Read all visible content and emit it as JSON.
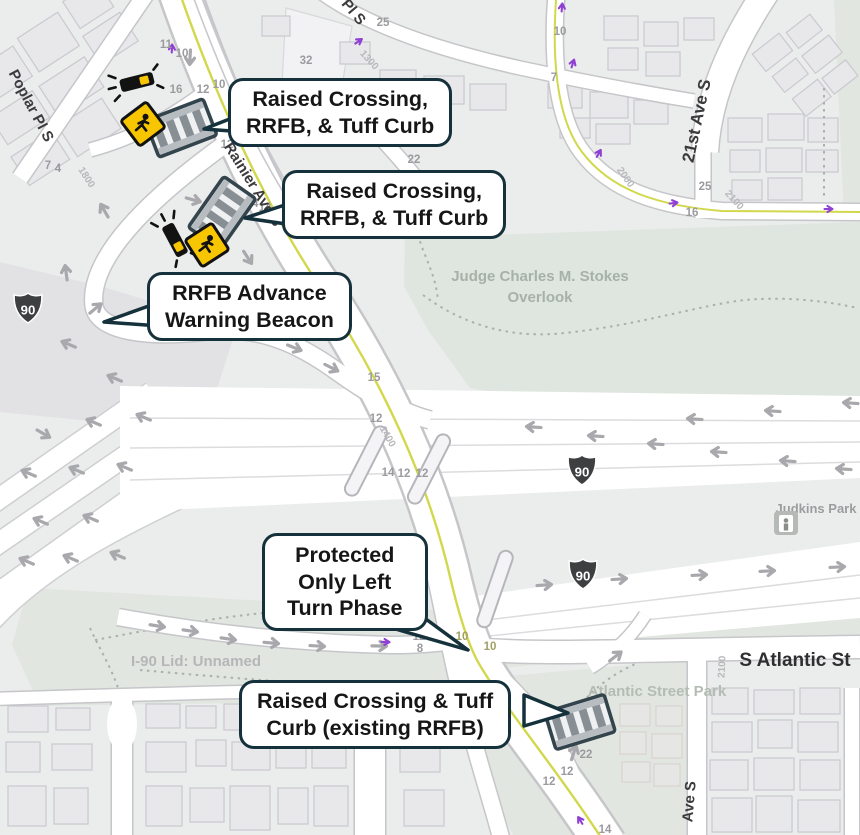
{
  "map": {
    "callouts": [
      {
        "text": "Raised Crossing,\nRRFB, & Tuff Curb"
      },
      {
        "text": "Raised Crossing,\nRRFB, & Tuff Curb"
      },
      {
        "text": "RRFB Advance\nWarning Beacon"
      },
      {
        "text": "Protected\nOnly Left\nTurn Phase"
      },
      {
        "text": "Raised Crossing & Tuff\nCurb (existing RRFB)"
      }
    ],
    "street_labels": [
      "Poplar Pl S",
      "Rainier Ave S",
      "Pl S",
      "21st Ave S",
      "S Atlantic St",
      "Ave S"
    ],
    "place_labels": [
      "Judge Charles M. Stokes",
      "Overlook",
      "Judkins Park",
      "I-90 Lid: Unnamed",
      "Atlantic Street Park"
    ],
    "route_shields": [
      "90",
      "90",
      "90"
    ],
    "road_numbers": [
      "11",
      "10",
      "16",
      "12",
      "10",
      "12",
      "7",
      "4",
      "14",
      "14",
      "22",
      "25",
      "32",
      "15",
      "12",
      "14",
      "12",
      "12",
      "12",
      "8",
      "10",
      "10",
      "12",
      "22",
      "12",
      "12",
      "14",
      "10",
      "7",
      "25",
      "16"
    ],
    "block_numbers": [
      "1800",
      "1300",
      "1400",
      "2000",
      "2100",
      "2100"
    ],
    "icons": {
      "rrfb_beacon": "flashing-beacon",
      "pedestrian_sign": "pedestrian-warning-sign",
      "raised_crossing": "raised-crosswalk",
      "transit_station": "light-rail-station",
      "interstate_shield": "interstate-90-shield",
      "bike_marker": "bike-route-arrow"
    },
    "colors": {
      "callout_border": "#15313b",
      "callout_bg": "#ffffff",
      "map_bg": "#ebecec",
      "park": "#e1e6e0",
      "road": "#ffffff",
      "road_casing": "#c6c6ca",
      "center_line": "#d2d84c",
      "arrow": "#a9a9ad",
      "bike_marker": "#8f3fd4",
      "shield": "#3e3f41",
      "sign_yellow": "#f7c600",
      "crosswalk_border": "#33444d"
    }
  }
}
